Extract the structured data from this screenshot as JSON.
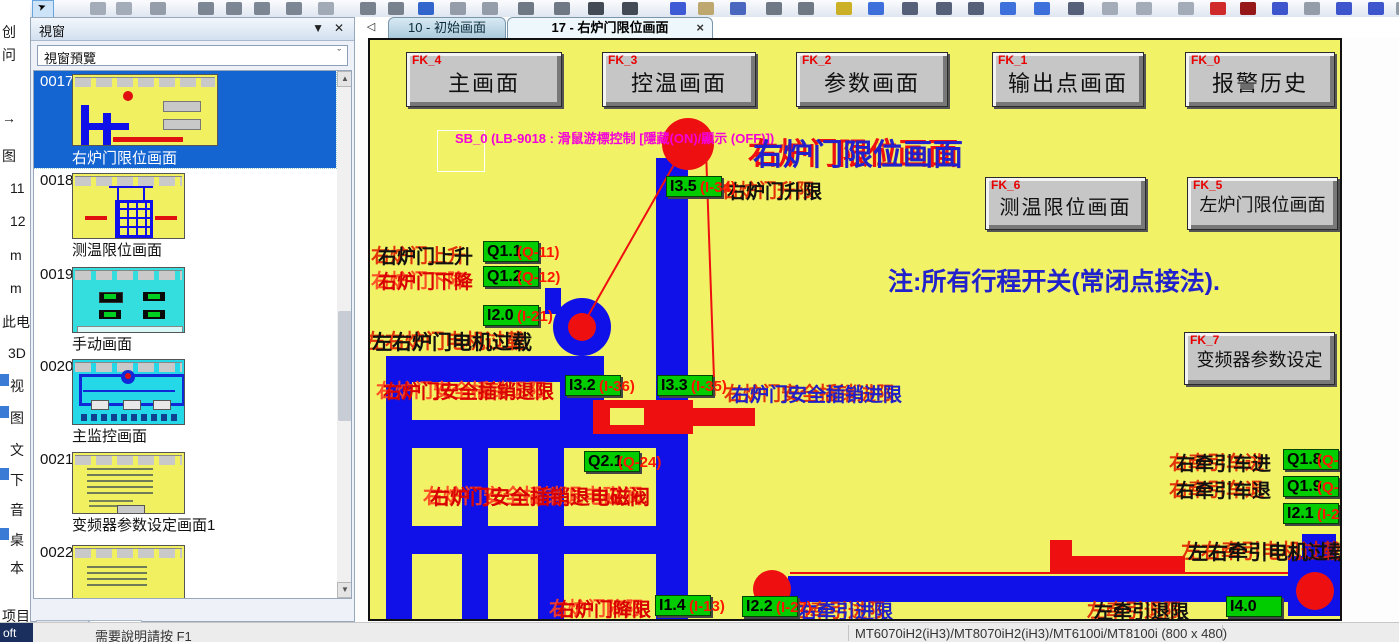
{
  "edge_strip": {
    "items": [
      "创",
      "问",
      "→",
      "图",
      "11",
      "12",
      "m",
      "m",
      "此电",
      "3D",
      "视",
      "图",
      "文",
      "下",
      "音",
      "桌",
      "本",
      "项目"
    ]
  },
  "left_panel": {
    "title": "視窗",
    "preview_label": "視窗預覽",
    "bottom_tabs": {
      "address": "位址",
      "window": "視窗"
    },
    "thumbnails": [
      {
        "num": "0017",
        "label": "右炉门限位画面"
      },
      {
        "num": "0018",
        "label": "测温限位画面"
      },
      {
        "num": "0019",
        "label": "手动画面"
      },
      {
        "num": "0020",
        "label": "主监控画面"
      },
      {
        "num": "0021",
        "label": "变频器参数设定画面1"
      },
      {
        "num": "0022",
        "label": ""
      }
    ]
  },
  "glyphs": {
    "collapse": "▼",
    "close": "✕",
    "chevron": "ˇ",
    "up": "▲",
    "down": "▼",
    "nav_left": "◁",
    "tab_close": "×"
  },
  "doc_tabs": {
    "tab1": "10 - 初始画面",
    "tab2": "17 - 右炉门限位画面"
  },
  "statusbar": {
    "chip": "oft",
    "help": "需要說明請按 F1",
    "model": "MT6070iH2(iH3)/MT8070iH2(iH3)/MT6100i/MT8100i (800 x 480)"
  },
  "canvas": {
    "sb_note": "SB_0 (LB-9018 : 滑鼠游標控制 [隱藏(ON)/顯示 (OFF)])",
    "title": "右炉门限位画面",
    "note": "注:所有行程开关(常闭点接法).",
    "buttons": [
      {
        "tag": "FK_4",
        "label": "主画面"
      },
      {
        "tag": "FK_3",
        "label": "控温画面"
      },
      {
        "tag": "FK_2",
        "label": "参数画面"
      },
      {
        "tag": "FK_1",
        "label": "输出点画面"
      },
      {
        "tag": "FK_0",
        "label": "报警历史"
      },
      {
        "tag": "FK_6",
        "label": "测温限位画面"
      },
      {
        "tag": "FK_5",
        "label": "左炉门限位画面"
      },
      {
        "tag": "FK_7",
        "label": "变频器参数设定"
      }
    ],
    "labels": [
      {
        "text": "右炉门升限"
      },
      {
        "text": "右炉门上升"
      },
      {
        "text": "右炉门下降"
      },
      {
        "text": "左右炉门电机过载"
      },
      {
        "text": "右炉门安全插销退限"
      },
      {
        "text": "右炉门安全插销进限"
      },
      {
        "text": "右炉门安全插销退电磁阀"
      },
      {
        "text": "右炉门降限"
      },
      {
        "text": "右牵引车进"
      },
      {
        "text": "右牵引车退"
      },
      {
        "text": "左右牵引电机过载"
      },
      {
        "text": "右牵引进限"
      },
      {
        "text": "左牵引退限"
      }
    ],
    "tags": [
      {
        "value": "I3.5",
        "pin": "(I-34)"
      },
      {
        "value": "Q1.1",
        "pin": "(Q-11)"
      },
      {
        "value": "Q1.2",
        "pin": "(Q-12)"
      },
      {
        "value": "I2.0",
        "pin": "(I-21)"
      },
      {
        "value": "I3.2",
        "pin": "(I-36)"
      },
      {
        "value": "I3.3",
        "pin": "(I-35)"
      },
      {
        "value": "Q2.1",
        "pin": "(Q-24)"
      },
      {
        "value": "I1.4",
        "pin": "(I-13)"
      },
      {
        "value": "Q1.8",
        "pin": "(Q-15)"
      },
      {
        "value": "Q1.9",
        "pin": "(Q-16)"
      },
      {
        "value": "I2.1",
        "pin": "(I-22)"
      },
      {
        "value": "I2.2",
        "pin": "(I-27)"
      },
      {
        "value": "I4.0",
        "pin": ""
      }
    ],
    "colors": {
      "screen_bg": "#F2F266",
      "tag_green": "#00CC00",
      "shape_blue": "#1010E8",
      "accent_red": "#EE1010",
      "note_magenta": "#F400D8",
      "title_blue": "#2222CC",
      "selection_blue": "#1464D2"
    }
  }
}
